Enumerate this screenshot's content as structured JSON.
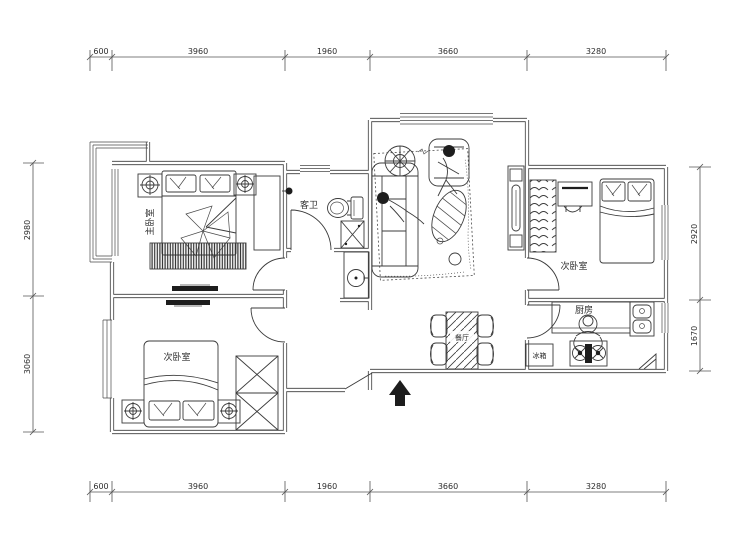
{
  "plan": {
    "type": "residential-floor-plan",
    "rooms": {
      "master_bedroom": {
        "label": "主卧室"
      },
      "second_bedroom_left": {
        "label": "次卧室"
      },
      "second_bedroom_right": {
        "label": "次卧室"
      },
      "guest_bathroom": {
        "label": "客卫"
      },
      "kitchen": {
        "label": "厨房"
      },
      "dining": {
        "label": "餐厅"
      },
      "fridge": {
        "label": "冰箱"
      }
    },
    "dimensions": {
      "top": [
        "600",
        "3960",
        "1960",
        "3660",
        "3280"
      ],
      "bottom": [
        "600",
        "3960",
        "1960",
        "3660",
        "3280"
      ],
      "left": [
        "2980",
        "3060"
      ],
      "right": [
        "2920",
        "1670"
      ]
    },
    "colors": {
      "line": "#3b3b3b",
      "background": "#ffffff",
      "solid_fill": "#1d1d1d"
    }
  }
}
